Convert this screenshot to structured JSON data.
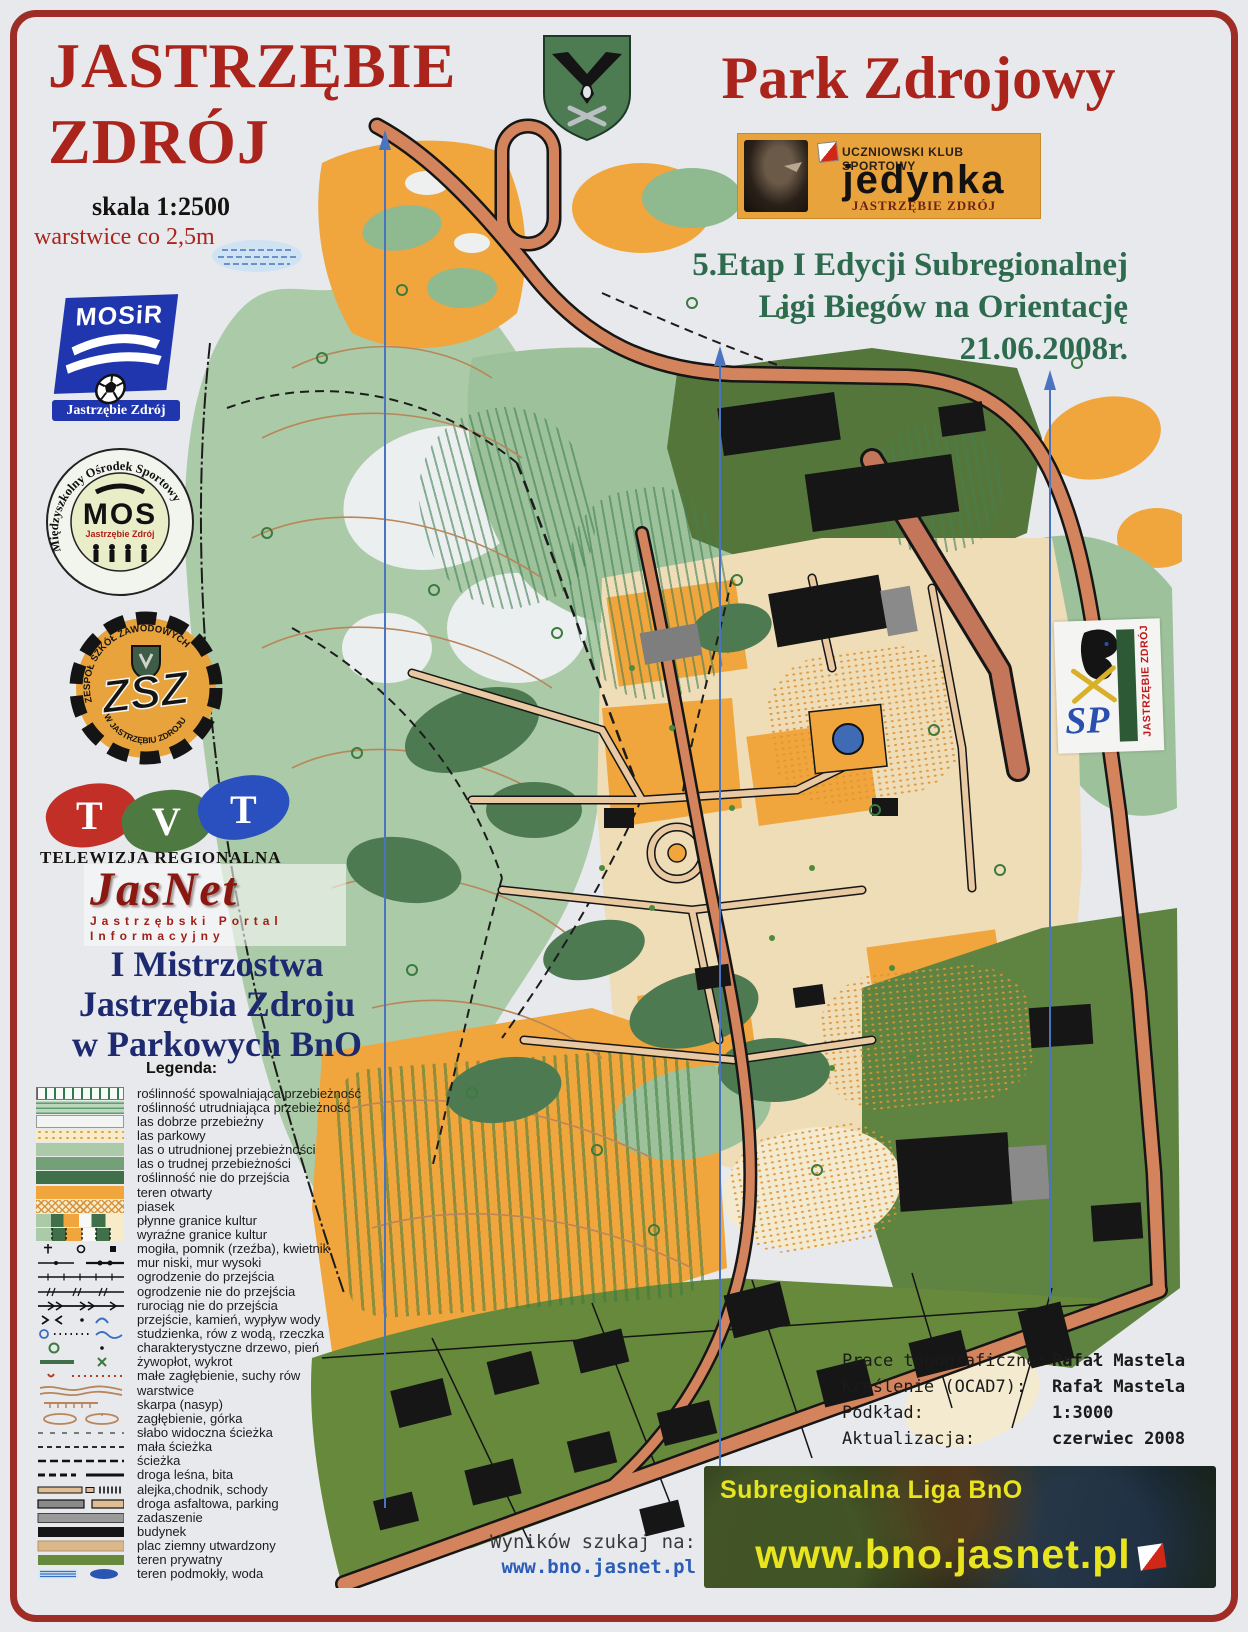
{
  "header": {
    "title_left_line1": "JASTRZĘBIE",
    "title_left_line2": "ZDRÓJ",
    "scale": "skala 1:2500",
    "contour_note": "warstwice co 2,5m",
    "title_right": "Park Zdrojowy"
  },
  "event": {
    "line1": "5.Etap I Edycji  Subregionalnej",
    "line2": "Ligi Biegów na Orientację",
    "line3": "21.06.2008r."
  },
  "sponsor_jedynka": {
    "top": "UCZNIOWSKI KLUB SPORTOWY",
    "name": "jedynka",
    "bottom": "JASTRZĘBIE ZDRÓJ"
  },
  "logos": {
    "mosir": {
      "name": "MOSiR",
      "city": "Jastrzębie Zdrój"
    },
    "mos": {
      "ring": "Międzyszkolny Ośrodek Sportowy",
      "name": "MOS",
      "city": "Jastrzębie Zdrój"
    },
    "zsz": {
      "ring_top": "ZESPÓŁ SZKÓŁ ZAWODOWYCH",
      "ring_bottom": "W JASTRZĘBIU ZDROJU",
      "name": "ZSZ"
    },
    "tvt": {
      "l1": "T",
      "l2": "V",
      "l3": "T",
      "caption": "TELEWIZJA REGIONALNA"
    },
    "jasnet": {
      "name": "JasNet",
      "caption1": "Jastrzębski Portal",
      "caption2": "Informacyjny"
    },
    "sp1": {
      "sp": "SP",
      "city": "JASTRZĘBIE ZDRÓJ"
    }
  },
  "championship": {
    "line1": "I  Mistrzostwa",
    "line2": "Jastrzębia Zdroju",
    "line3": "w Parkowych  BnO"
  },
  "legend": {
    "title": "Legenda:",
    "items": [
      "roślinność spowalniająca przebieżność",
      "roślinność utrudniająca przebieżność",
      "las dobrze przebieżny",
      "las parkowy",
      "las o utrudnionej przebieżności",
      "las o trudnej przebieżności",
      "roślinność nie do przejścia",
      "teren otwarty",
      "piasek",
      "płynne granice kultur",
      "wyraźne granice kultur",
      "mogiła, pomnik (rzeźba), kwietnik",
      "mur niski, mur wysoki",
      "ogrodzenie do przejścia",
      "ogrodzenie nie do przejścia",
      "rurociąg nie do przejścia",
      "przejście, kamień, wypływ wody",
      "studzienka, rów z wodą, rzeczka",
      "charakterystyczne drzewo, pień",
      "żywopłot, wykrot",
      "małe zagłębienie, suchy rów",
      "warstwice",
      "skarpa (nasyp)",
      "zagłębienie, górka",
      "słabo widoczna ścieżka",
      "mała ścieżka",
      "ścieżka",
      "droga leśna, bita",
      "alejka,chodnik,  schody",
      "droga asfaltowa, parking",
      "zadaszenie",
      "budynek",
      "plac ziemny utwardzony",
      "teren prywatny",
      "teren podmokły, woda"
    ]
  },
  "credits": {
    "rows": [
      {
        "label": "Prace topograficzne:",
        "value": "Rafał Mastela"
      },
      {
        "label": "Kreślenie (OCAD7):",
        "value": "Rafał Mastela"
      },
      {
        "label": "Podkład:",
        "value": "1:3000"
      },
      {
        "label": "Aktualizacja:",
        "value": "czerwiec 2008"
      }
    ]
  },
  "results": {
    "label": "Wyników szukaj na:",
    "url": "www.bno.jasnet.pl"
  },
  "banner": {
    "title": "Subregionalna Liga BnO",
    "url": "www.bno.jasnet.pl"
  },
  "colors": {
    "title_red": "#ab241c",
    "event_green": "#2e6b4e",
    "navy": "#1e2a70",
    "open_terrain_orange": "#f0a63c",
    "road_salmon": "#d4845c",
    "private_olive": "#66893c",
    "water_blue": "#3f6bb5",
    "north_line_blue": "#4a74c0",
    "border_red": "#9e2d26",
    "banner_yellow": "#e8e41e"
  }
}
